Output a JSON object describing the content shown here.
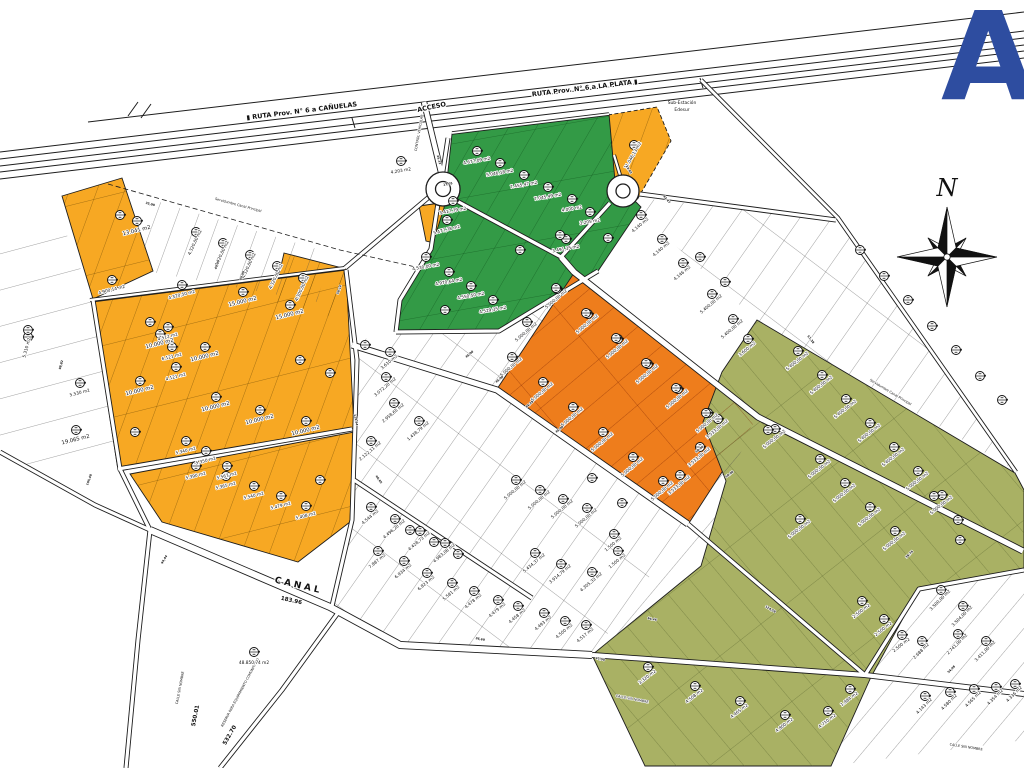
{
  "map": {
    "colors": {
      "yellow": "#F7A823",
      "orange": "#EE7D1C",
      "green": "#339A46",
      "olive": "#A9B164",
      "logo_blue": "#2E4DA0",
      "line": "#1d1d1d"
    },
    "logo": {
      "letter": "A"
    },
    "compass": {
      "label": "N"
    },
    "annotations": [
      {
        "t": "▮ RUTA Prov. N° 6 a CAÑUELAS",
        "x": 302,
        "y": 113,
        "r": -7,
        "s": 6.5,
        "cls": "rlabel"
      },
      {
        "t": "RUTA Prov. N° 6 a LA PLATA ▮",
        "x": 585,
        "y": 90,
        "r": -7,
        "s": 6.5,
        "cls": "rlabel"
      },
      {
        "t": "ACCESO",
        "x": 432,
        "y": 109,
        "r": -12,
        "s": 6,
        "cls": "rlabel"
      },
      {
        "t": "CONTROL VEHICULAR",
        "x": 420,
        "y": 133,
        "r": -80,
        "s": 3,
        "cls": "tiny"
      },
      {
        "t": "Sub-Estación",
        "x": 682,
        "y": 104,
        "r": 0,
        "s": 4.4,
        "cls": "tiny2"
      },
      {
        "t": "Edesur",
        "x": 682,
        "y": 111,
        "r": 0,
        "s": 4.4,
        "cls": "tiny2"
      },
      {
        "t": "CANAL",
        "x": 298,
        "y": 588,
        "r": 13,
        "s": 9,
        "cls": "canal"
      },
      {
        "t": "183.96",
        "x": 291,
        "y": 602,
        "r": 13,
        "s": 5,
        "cls": "dim2"
      },
      {
        "t": "550.01",
        "x": 197,
        "y": 716,
        "r": -79,
        "s": 6,
        "cls": "dim2"
      },
      {
        "t": "532.70",
        "x": 231,
        "y": 736,
        "r": -60,
        "s": 6,
        "cls": "dim2"
      },
      {
        "t": "CALLE SIN NOMBRE",
        "x": 181,
        "y": 688,
        "r": -79,
        "s": 3.6,
        "cls": "tiny"
      },
      {
        "t": "CALLE SIN NOMBRE",
        "x": 632,
        "y": 700,
        "r": 11,
        "s": 3.6,
        "cls": "tiny"
      },
      {
        "t": "CALLE SIN NOMBRE",
        "x": 966,
        "y": 748,
        "r": 9,
        "s": 3.6,
        "cls": "tiny"
      },
      {
        "t": "RESERVA PARA EQUIPAMIENTO COMUNITARIO",
        "x": 241,
        "y": 693,
        "r": -62,
        "s": 4.2,
        "cls": "tiny"
      },
      {
        "t": "48.850,74 m2",
        "x": 254,
        "y": 664,
        "r": 0,
        "s": 4.5,
        "cls": "plabel"
      },
      {
        "t": "Servidumbre Canal Principal",
        "x": 238,
        "y": 206,
        "r": 15,
        "s": 3.4,
        "cls": "tiny"
      },
      {
        "t": "Servidumbre Canal Principal",
        "x": 890,
        "y": 393,
        "r": 31,
        "s": 3.4,
        "cls": "tiny"
      }
    ],
    "parcel_labels": [
      [
        "13.041 m2",
        137,
        232,
        -14,
        1
      ],
      [
        "4.900,14 m2",
        112,
        291,
        -14,
        0
      ],
      [
        "4.320,50 m2",
        182,
        296,
        -14,
        0
      ],
      [
        "4.512 m2",
        168,
        338,
        -14,
        0
      ],
      [
        "6.121 m2",
        172,
        358,
        -14,
        0
      ],
      [
        "4.121 m2",
        176,
        378,
        -14,
        0
      ],
      [
        "15.000 m2",
        243,
        303,
        -14,
        1
      ],
      [
        "15.000 m2",
        290,
        316,
        -14,
        1
      ],
      [
        "10.000 m2",
        160,
        345,
        -14,
        1
      ],
      [
        "10.000 m2",
        205,
        358,
        -14,
        1
      ],
      [
        "10.000 m2",
        140,
        392,
        -14,
        1
      ],
      [
        "10.000 m2",
        216,
        408,
        -14,
        1
      ],
      [
        "10.000 m2",
        260,
        421,
        -14,
        1
      ],
      [
        "10.000 m2",
        306,
        432,
        -14,
        1
      ],
      [
        "5.390 m2",
        196,
        477,
        -14,
        0
      ],
      [
        "5.365 m2",
        226,
        487,
        -14,
        0
      ],
      [
        "5.540 m2",
        254,
        497,
        -14,
        0
      ],
      [
        "5.479 m2",
        281,
        507,
        -14,
        0
      ],
      [
        "5.408 m2",
        306,
        517,
        -14,
        0
      ],
      [
        "5.477,78 m2",
        447,
        231,
        -14,
        0
      ],
      [
        "3.417,79 m2",
        453,
        212,
        -10,
        0
      ],
      [
        "11.046,13 m2",
        634,
        156,
        -60,
        0
      ],
      [
        "4.320,00 m2",
        196,
        243,
        -65,
        0
      ],
      [
        "4.320,00 m2",
        223,
        254,
        -65,
        0
      ],
      [
        "4.320,00 m2",
        250,
        266,
        -65,
        0
      ],
      [
        "4.320,00 m2",
        277,
        277,
        -65,
        0
      ],
      [
        "4.300,00 m2",
        303,
        289,
        -65,
        0
      ],
      [
        "5.310 m2",
        28,
        348,
        -75,
        0
      ],
      [
        "19.065 m2",
        76,
        441,
        -14,
        1
      ],
      [
        "5.530 m2",
        80,
        394,
        -14,
        0
      ],
      [
        "5.340 m2",
        186,
        452,
        -14,
        0
      ],
      [
        "5.350 m2",
        206,
        462,
        -14,
        0
      ],
      [
        "5.567 m2",
        227,
        477,
        -14,
        0
      ],
      [
        "4.203 m2",
        401,
        172,
        -10,
        0
      ],
      [
        "4.677,09 m2",
        477,
        162,
        -10,
        0
      ],
      [
        "5.046,18 m2",
        500,
        174,
        -10,
        0
      ],
      [
        "7.455,47 m2",
        524,
        186,
        -10,
        0
      ],
      [
        "7.045,49 m2",
        548,
        198,
        -10,
        0
      ],
      [
        "4.000 m2",
        572,
        210,
        -10,
        0
      ],
      [
        "3.205 m2",
        590,
        223,
        -10,
        0
      ],
      [
        "3.491,35 m2",
        566,
        250,
        -10,
        0
      ],
      [
        "4.530,00 m2",
        426,
        268,
        -10,
        0
      ],
      [
        "4.970,64 m2",
        449,
        283,
        -10,
        0
      ],
      [
        "4.550,50 m2",
        471,
        297,
        -10,
        0
      ],
      [
        "4.529,35 m2",
        493,
        311,
        -10,
        0
      ],
      [
        "5.000,00 m2",
        557,
        300,
        -40,
        0
      ],
      [
        "5.000,00 m2",
        588,
        325,
        -40,
        0
      ],
      [
        "5.000,00 m2",
        618,
        350,
        -40,
        0
      ],
      [
        "5.000,00 m2",
        648,
        375,
        -40,
        0
      ],
      [
        "5.000,00 m2",
        678,
        400,
        -40,
        0
      ],
      [
        "5.000,00 m2",
        708,
        424,
        -40,
        0
      ],
      [
        "5.000,00 m2",
        527,
        333,
        -40,
        0
      ],
      [
        "5.000,00 m2",
        512,
        368,
        -40,
        0
      ],
      [
        "5.000,00 m2",
        543,
        393,
        -40,
        0
      ],
      [
        "5.000,00 m2",
        573,
        418,
        -40,
        0
      ],
      [
        "5.000,00 m2",
        603,
        443,
        -40,
        0
      ],
      [
        "5.000,00 m2",
        633,
        468,
        -40,
        0
      ],
      [
        "5.000,00 m2",
        663,
        492,
        -40,
        0
      ],
      [
        "3.533,00 m2",
        718,
        430,
        -40,
        0
      ],
      [
        "3.533,00 m2",
        700,
        458,
        -40,
        0
      ],
      [
        "3.533,00 m2",
        680,
        486,
        -40,
        0
      ],
      [
        "4.140 m2",
        641,
        226,
        -40,
        0
      ],
      [
        "4.140 m2",
        662,
        250,
        -40,
        0
      ],
      [
        "4.146 m2",
        683,
        274,
        -40,
        0
      ],
      [
        "5.400,00 m2",
        712,
        305,
        -40,
        0
      ],
      [
        "5.400,00 m2",
        733,
        330,
        -40,
        0
      ],
      [
        "3.600 m2",
        748,
        350,
        -40,
        0
      ],
      [
        "5.400,00 m2",
        798,
        362,
        -38,
        0
      ],
      [
        "5.400,00 m2",
        822,
        386,
        -38,
        0
      ],
      [
        "5.400,00 m2",
        846,
        410,
        -38,
        0
      ],
      [
        "5.400,00 m2",
        870,
        434,
        -38,
        0
      ],
      [
        "5.400,00 m2",
        894,
        458,
        -38,
        0
      ],
      [
        "5.000,00 m2",
        918,
        482,
        -38,
        0
      ],
      [
        "5.000,00 m2",
        942,
        506,
        -38,
        0
      ],
      [
        "5.000,00 m2",
        820,
        470,
        -38,
        0
      ],
      [
        "5.000,00 m2",
        845,
        494,
        -38,
        0
      ],
      [
        "5.000,00 m2",
        870,
        518,
        -38,
        0
      ],
      [
        "5.000,00 m2",
        895,
        542,
        -38,
        0
      ],
      [
        "5.000,00 m2",
        775,
        440,
        -38,
        0
      ],
      [
        "5.000,00 m2",
        800,
        530,
        -38,
        0
      ],
      [
        "2.500 m2",
        862,
        612,
        -38,
        0
      ],
      [
        "2.500 m2",
        884,
        630,
        -38,
        0
      ],
      [
        "2.500 m2",
        902,
        646,
        -38,
        0
      ],
      [
        "3.320 m2",
        648,
        678,
        -38,
        0
      ],
      [
        "4.508 m2",
        695,
        697,
        -38,
        0
      ],
      [
        "4.465 m2",
        740,
        712,
        -38,
        0
      ],
      [
        "4.800 m2",
        785,
        726,
        -38,
        0
      ],
      [
        "1.984 m2",
        850,
        700,
        -38,
        0
      ],
      [
        "4.710 m2",
        828,
        722,
        -38,
        0
      ],
      [
        "3.500,00 m2",
        941,
        601,
        -45,
        0
      ],
      [
        "3.504,00 m2",
        963,
        617,
        -45,
        0
      ],
      [
        "2.741,00 m2",
        958,
        645,
        -45,
        0
      ],
      [
        "3.411,00 m2",
        986,
        652,
        -45,
        0
      ],
      [
        "2.688 m2",
        922,
        652,
        -45,
        0
      ],
      [
        "4.143 m2",
        925,
        707,
        -45,
        0
      ],
      [
        "4.580 m2",
        950,
        703,
        -45,
        0
      ],
      [
        "4.565 m2",
        974,
        700,
        -45,
        0
      ],
      [
        "4.354 m2",
        996,
        698,
        -45,
        0
      ],
      [
        "4.336 m2",
        1015,
        695,
        -45,
        0
      ],
      [
        "3.610 m2",
        390,
        363,
        -40,
        0
      ],
      [
        "3.072,20 m2",
        386,
        388,
        -40,
        0
      ],
      [
        "2.958,65 m2",
        394,
        414,
        -40,
        0
      ],
      [
        "2.122,11 m2",
        371,
        452,
        -40,
        0
      ],
      [
        "1.438,79 m2",
        419,
        432,
        -40,
        0
      ],
      [
        "7.887 m2",
        378,
        562,
        -40,
        0
      ],
      [
        "6.934 m2",
        404,
        572,
        -40,
        0
      ],
      [
        "6.823 m2",
        427,
        584,
        -40,
        0
      ],
      [
        "5.581 m2",
        452,
        594,
        -40,
        0
      ],
      [
        "4.478 m2",
        474,
        602,
        -40,
        0
      ],
      [
        "4.479 m2",
        498,
        611,
        -40,
        0
      ],
      [
        "4.458 m2",
        518,
        617,
        -40,
        0
      ],
      [
        "4.493 m2",
        544,
        624,
        -40,
        0
      ],
      [
        "4.500 m2",
        565,
        632,
        -40,
        0
      ],
      [
        "4.517 m2",
        586,
        636,
        -40,
        0
      ],
      [
        "5.434,37 m2",
        535,
        564,
        -40,
        0
      ],
      [
        "3.914,79 m2",
        561,
        575,
        -40,
        0
      ],
      [
        "4.305,33 m2",
        592,
        583,
        -40,
        0
      ],
      [
        "1.500 m2",
        614,
        545,
        -40,
        0
      ],
      [
        "1.500 m2",
        618,
        562,
        -40,
        0
      ],
      [
        "5.000,00 m2",
        516,
        491,
        -40,
        0
      ],
      [
        "5.000,00 m2",
        540,
        501,
        -40,
        0
      ],
      [
        "5.000,00 m2",
        563,
        510,
        -40,
        0
      ],
      [
        "5.000,00 m2",
        587,
        519,
        -40,
        0
      ],
      [
        "4.544 m2",
        371,
        518,
        -40,
        0
      ],
      [
        "4.496,20 m2",
        395,
        530,
        -40,
        0
      ],
      [
        "4.428,73 m2",
        420,
        542,
        -40,
        0
      ],
      [
        "4.983,08 m2",
        445,
        554,
        -40,
        0
      ]
    ],
    "extra_markers": [
      [
        254,
        652
      ],
      [
        556,
        288
      ],
      [
        586,
        313
      ],
      [
        616,
        338
      ],
      [
        646,
        363
      ],
      [
        676,
        388
      ],
      [
        706,
        413
      ],
      [
        592,
        478
      ],
      [
        622,
        503
      ],
      [
        934,
        496
      ],
      [
        958,
        520
      ],
      [
        768,
        430
      ],
      [
        960,
        540
      ],
      [
        560,
        235
      ],
      [
        520,
        250
      ],
      [
        445,
        310
      ],
      [
        608,
        238
      ],
      [
        120,
        215
      ],
      [
        150,
        322
      ],
      [
        300,
        360
      ],
      [
        330,
        373
      ],
      [
        135,
        432
      ],
      [
        320,
        480
      ],
      [
        365,
        345
      ],
      [
        700,
        257
      ],
      [
        725,
        282
      ],
      [
        410,
        530
      ],
      [
        434,
        542
      ],
      [
        458,
        554
      ],
      [
        28,
        330
      ],
      [
        860,
        250
      ],
      [
        884,
        276
      ],
      [
        908,
        300
      ],
      [
        932,
        326
      ],
      [
        956,
        350
      ],
      [
        980,
        376
      ],
      [
        1002,
        400
      ]
    ],
    "dim_labels": [
      [
        "45,00",
        470,
        355,
        -40
      ],
      [
        "45,00",
        500,
        380,
        -40
      ],
      [
        "44,28",
        530,
        405,
        -40
      ],
      [
        "45,00",
        560,
        430,
        -40
      ],
      [
        "43,47",
        666,
        200,
        50
      ],
      [
        "64,46",
        652,
        620,
        12
      ],
      [
        "58,14",
        340,
        290,
        -70
      ],
      [
        "129,94",
        355,
        420,
        80
      ],
      [
        "40,00",
        218,
        265,
        -70
      ],
      [
        "40,00",
        243,
        276,
        -70
      ],
      [
        "35,00",
        150,
        205,
        15
      ],
      [
        "46,65",
        378,
        480,
        55
      ],
      [
        "98,82",
        62,
        365,
        -75
      ],
      [
        "25,33",
        438,
        160,
        75
      ],
      [
        "50,00",
        700,
        450,
        -38
      ],
      [
        "50,00",
        730,
        475,
        -38
      ],
      [
        "57,38",
        810,
        340,
        52
      ],
      [
        "38,76",
        910,
        555,
        -45
      ],
      [
        "47,00",
        600,
        660,
        12
      ],
      [
        "124,58",
        770,
        610,
        30
      ],
      [
        "54,98",
        952,
        670,
        -45
      ],
      [
        "36,69",
        480,
        640,
        12
      ],
      [
        "94,44",
        165,
        560,
        -60
      ],
      [
        "105,48",
        90,
        480,
        -70
      ],
      [
        "17,05",
        448,
        185,
        -10
      ],
      [
        "23,02",
        628,
        170,
        60
      ]
    ]
  }
}
